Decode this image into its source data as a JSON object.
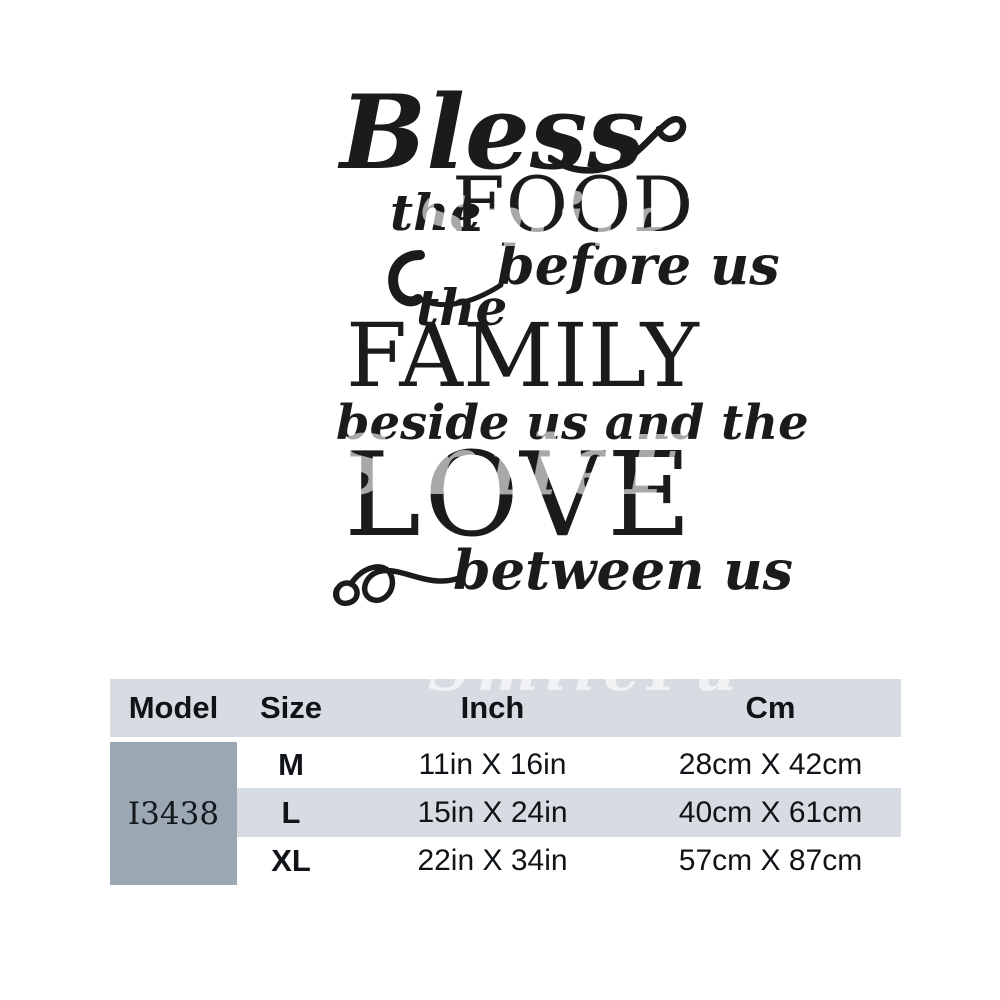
{
  "artwork": {
    "script_bless": "Bless",
    "word_the_1": "the",
    "caps_food": "FOOD",
    "script_before_us": "before us",
    "word_the_2": "the",
    "caps_family": "FAMILY",
    "script_beside": "beside us and the",
    "caps_love": "LOVE",
    "script_between_us": "between us"
  },
  "watermark": {
    "text": "SmileFu"
  },
  "size_table": {
    "headers": [
      "Model",
      "Size",
      "Inch",
      "Cm"
    ],
    "model": "I3438",
    "rows": [
      {
        "size": "M",
        "inch": "11in X 16in",
        "cm": "28cm X 42cm"
      },
      {
        "size": "L",
        "inch": "15in X 24in",
        "cm": "40cm X 61cm"
      },
      {
        "size": "XL",
        "inch": "22in X 34in",
        "cm": "57cm X 87cm"
      }
    ]
  },
  "colors": {
    "table_header_bg": "#d7dce2",
    "row_band_bg": "#d6dce1",
    "model_cell_bg": "#9ba8b4",
    "artwork_color": "#1b1b1b"
  }
}
